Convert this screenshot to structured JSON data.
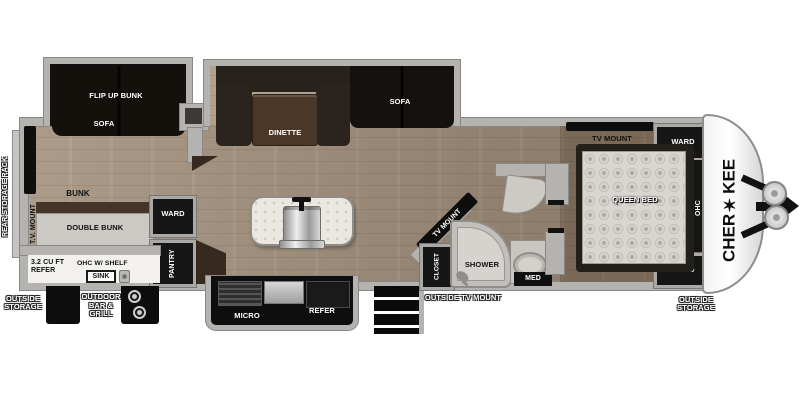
{
  "brand": {
    "logo": "CHER✶KEE"
  },
  "exterior_labels": {
    "rear_storage_rack": "REAR STORAGE RACK",
    "outside_storage_left": "OUTSIDE STORAGE",
    "outdoor_bar_grill": "OUTDOOR BAR & GRILL",
    "outside_tv_mount": "OUTSIDE TV MOUNT",
    "outside_storage_right": "OUTSIDE STORAGE"
  },
  "bunk_room": {
    "flip_up_bunk": "FLIP UP BUNK",
    "slide_sofa": "SOFA",
    "tv_mount": "T.V. MOUNT",
    "bunk": "BUNK",
    "double_bunk": "DOUBLE BUNK",
    "ward": "WARD",
    "pantry": "PANTRY"
  },
  "outdoor_kitchen": {
    "refer": "3.2 CU FT REFER",
    "ohc_shelf": "OHC W/ SHELF",
    "sink": "SINK"
  },
  "living_area": {
    "dinette": "DINETTE",
    "sofa": "SOFA"
  },
  "kitchen": {
    "micro": "MICRO",
    "refer": "REFER"
  },
  "bathroom": {
    "tv_mount": "TV MOUNT",
    "closet": "CLOSET",
    "shower": "SHOWER",
    "med": "MED"
  },
  "bedroom": {
    "tv_mount": "TV MOUNT",
    "ward_front": "WARD",
    "ohc": "OHC",
    "queen_bed": "QUEEN BED",
    "ward_rear": "WARD"
  },
  "colors": {
    "floor": "#a3907c",
    "wall": "#b5b3b0",
    "furniture_dark": "#17140f",
    "table_wood": "#4b3728"
  }
}
